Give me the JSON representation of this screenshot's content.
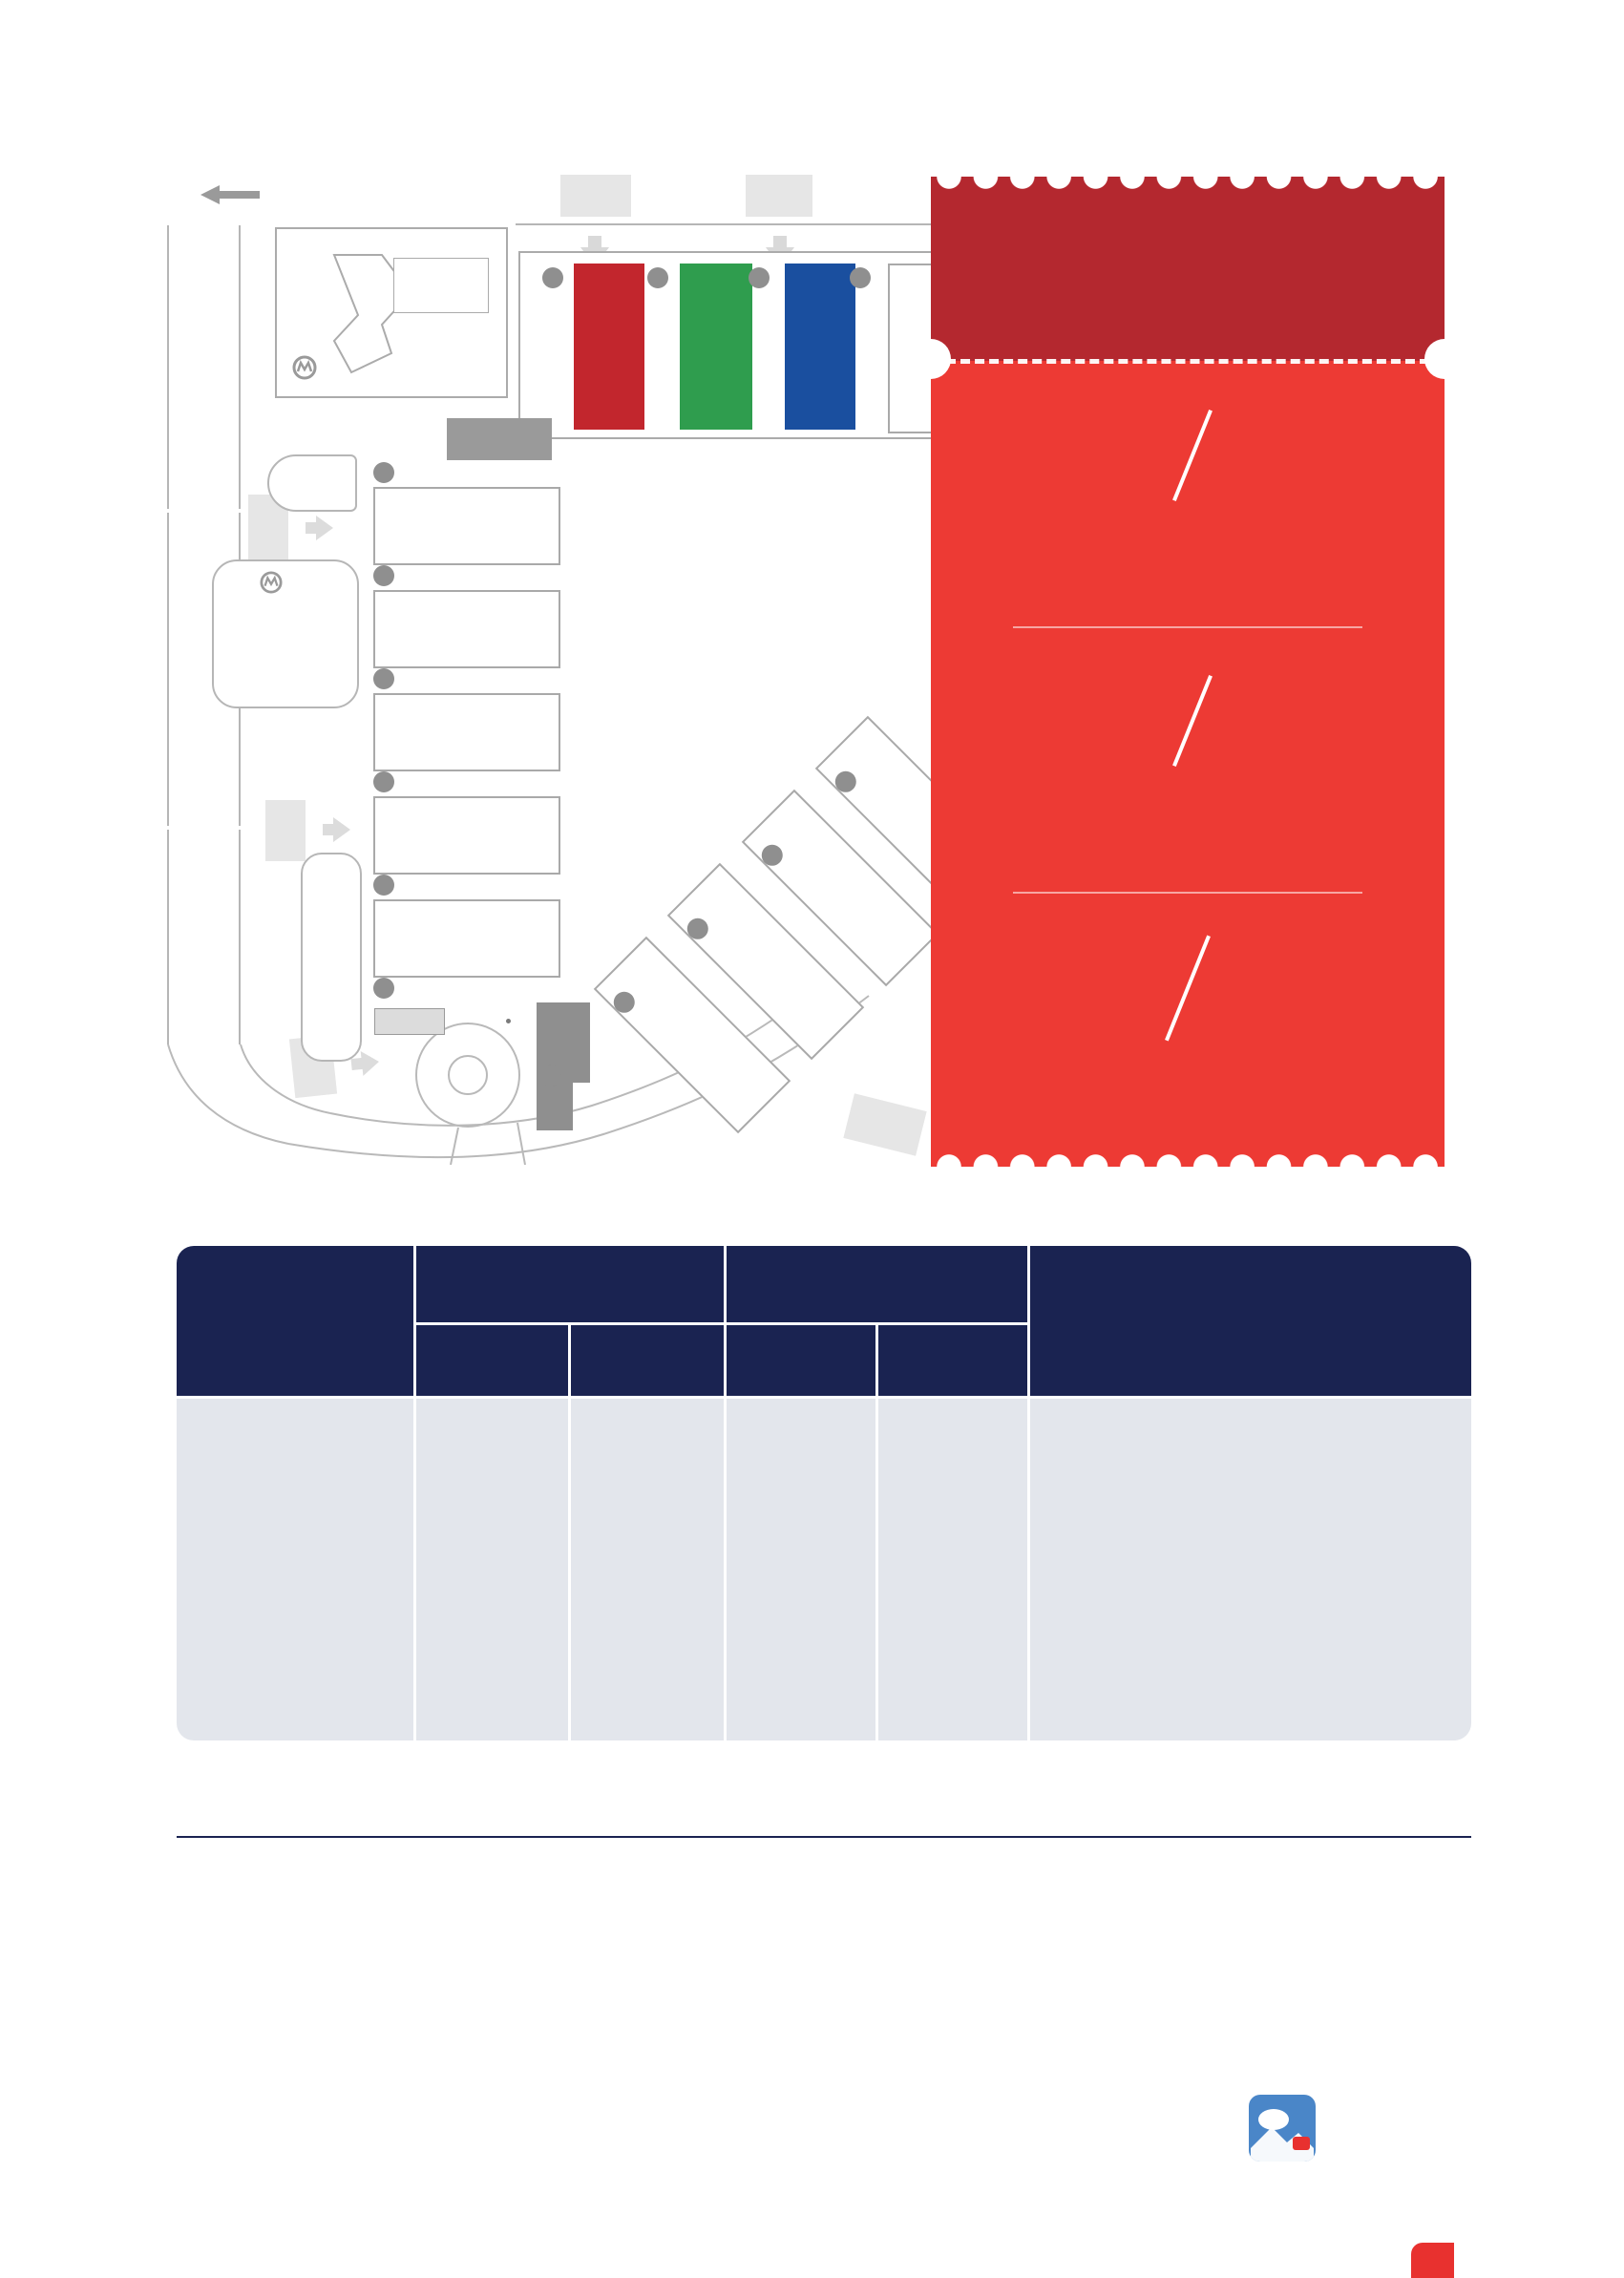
{
  "map": {
    "direction_cn": "东方路方向",
    "direction_en": "Dongfang Road Direction",
    "hotel_cn": "上海浦东嘉里大酒店",
    "hotel_en": "Kerry Hotel Pudong Shanghai",
    "metro_cn": "7号线",
    "metro_en": "Line 7",
    "gate4_num": "4",
    "gate5_num": "5",
    "gate3_num": "3",
    "gate2_num": "2",
    "gate1_num": "1",
    "gate10_num": "10",
    "gate_suffix": "号门",
    "road_huamu_cn": "花木路",
    "road_huamu_en": "Hua Mu Road",
    "road_meihua_cn": "梅花路",
    "road_meihua_en": "Mei Hua Road",
    "road_fangdian": "芳甸路 Fang Dian Road",
    "road_yinghua_cn": "樱花路",
    "road_yinghua_en": "Ying Hua Road",
    "road_lanhua_cn": "兰花路",
    "road_lanhua_en": "Lan Hua Road",
    "road_longyang_en": "Long Yang Road",
    "p6": "P6",
    "p5": "P5",
    "p4": "P4",
    "pvip_p": "P",
    "pvip_sub": "VIP",
    "entrance2_num": "2",
    "entrance1_num": "1",
    "entrance_hash": "#",
    "entrance_cn": "入口厅",
    "entrance_en": "Entrance Hall",
    "badge_center": "制证中心",
    "taxi": "TAXI",
    "halls_n": [
      "N1",
      "N2",
      "N3",
      "N4"
    ],
    "halls_w": [
      "W5",
      "W4",
      "W3",
      "W2",
      "W1"
    ],
    "halls_e": [
      "E4",
      "E3",
      "E2",
      "E1"
    ],
    "bays_n": [
      "7",
      "8",
      "9",
      "10"
    ],
    "bays_w": [
      "6",
      "5",
      "4",
      "3",
      "2",
      "1"
    ],
    "bays_e": [
      "16",
      "17",
      "18",
      "19",
      "20"
    ],
    "bay_cn": "号卸货区",
    "bay_en": "LOADING BAY"
  },
  "ticket": {
    "title_cn": "早 鸟 价",
    "title_en": "Early Bird Price",
    "tier1_value": "8.0",
    "tier1_unit": "折",
    "tier1_off": "20% off",
    "tier1_date_cn": "2024年8月3-31日",
    "tier1_date_en": "From August 3 to August 31, 2024",
    "tier2_value": "8.8",
    "tier2_unit": "折",
    "tier2_off": "12% off",
    "tier2_date_cn": "2024年9月1日-12月31日",
    "tier2_date_en": "From September 1 to December 31, 2024",
    "tier3_value": "原价",
    "tier3_off1": "No",
    "tier3_off2": "Discount",
    "tier3_date_cn": "2025年1月1日-2025年8月",
    "tier3_date_en": "From January 1 to August, 2025"
  },
  "table": {
    "header": {
      "spec_cn1": "展位规格",
      "spec_cn2": "（光地36 m² 起租）",
      "spec_en1": "Booth specifications",
      "spec_en2": "(Bare space to be rented",
      "spec_en3": "from 36 m²)",
      "domestic_cn": "国内展商（人民币/m²）",
      "domestic_en": "Domestic exhibitor (RMB/m²)",
      "intl_cn": "国际展商（USD/m²）",
      "intl_en": "International exhibitor (USD/m²)",
      "bare_cn": "光  地",
      "bare_en": "Bare space",
      "std_cn": "标  展",
      "std_en": "Standard booth",
      "remarks_cn": "备  注",
      "remarks_en": "Remarks"
    },
    "row": {
      "label_cn": "价  格",
      "label_en": "Price",
      "domestic_bare": "1 380",
      "domestic_std": "1 580",
      "intl_bare": "350",
      "intl_std": "380"
    },
    "remarks": {
      "cn_title": "附加费用:",
      "cn_lines": [
        "·两边开口展台: + 5%",
        "·三边开口展台: + 7.5%",
        "·独立展台: + 10%",
        "*附加费用适用于光地"
      ],
      "en_title": "ADDITIONAL CHARGES:",
      "en_lines": [
        "·Booth with two open sides: + 5%",
        "·Booth with three open sides: + 7.5%",
        "·Independent booth: + 10%",
        "*Additional charges apply to bare space"
      ]
    }
  },
  "footer": {
    "hotline_cn": "2025展位火热预订......",
    "hotline_en": "Sales Hotline",
    "contact_label": "展位预订联系人:",
    "contact_value": "杜　伟：137-61777-608"
  },
  "colors": {
    "ticket_header_red": "#B4282F",
    "ticket_body_red": "#ED3A34",
    "gold": "#E8D79F",
    "navy": "#1A2351",
    "table_cell_gray": "#E3E6EC",
    "hall_n1_red": "#C2262D",
    "hall_n2_green": "#2F9D4E",
    "hall_n3_blue": "#1A4F9F",
    "accent_red": "#E8312F"
  }
}
